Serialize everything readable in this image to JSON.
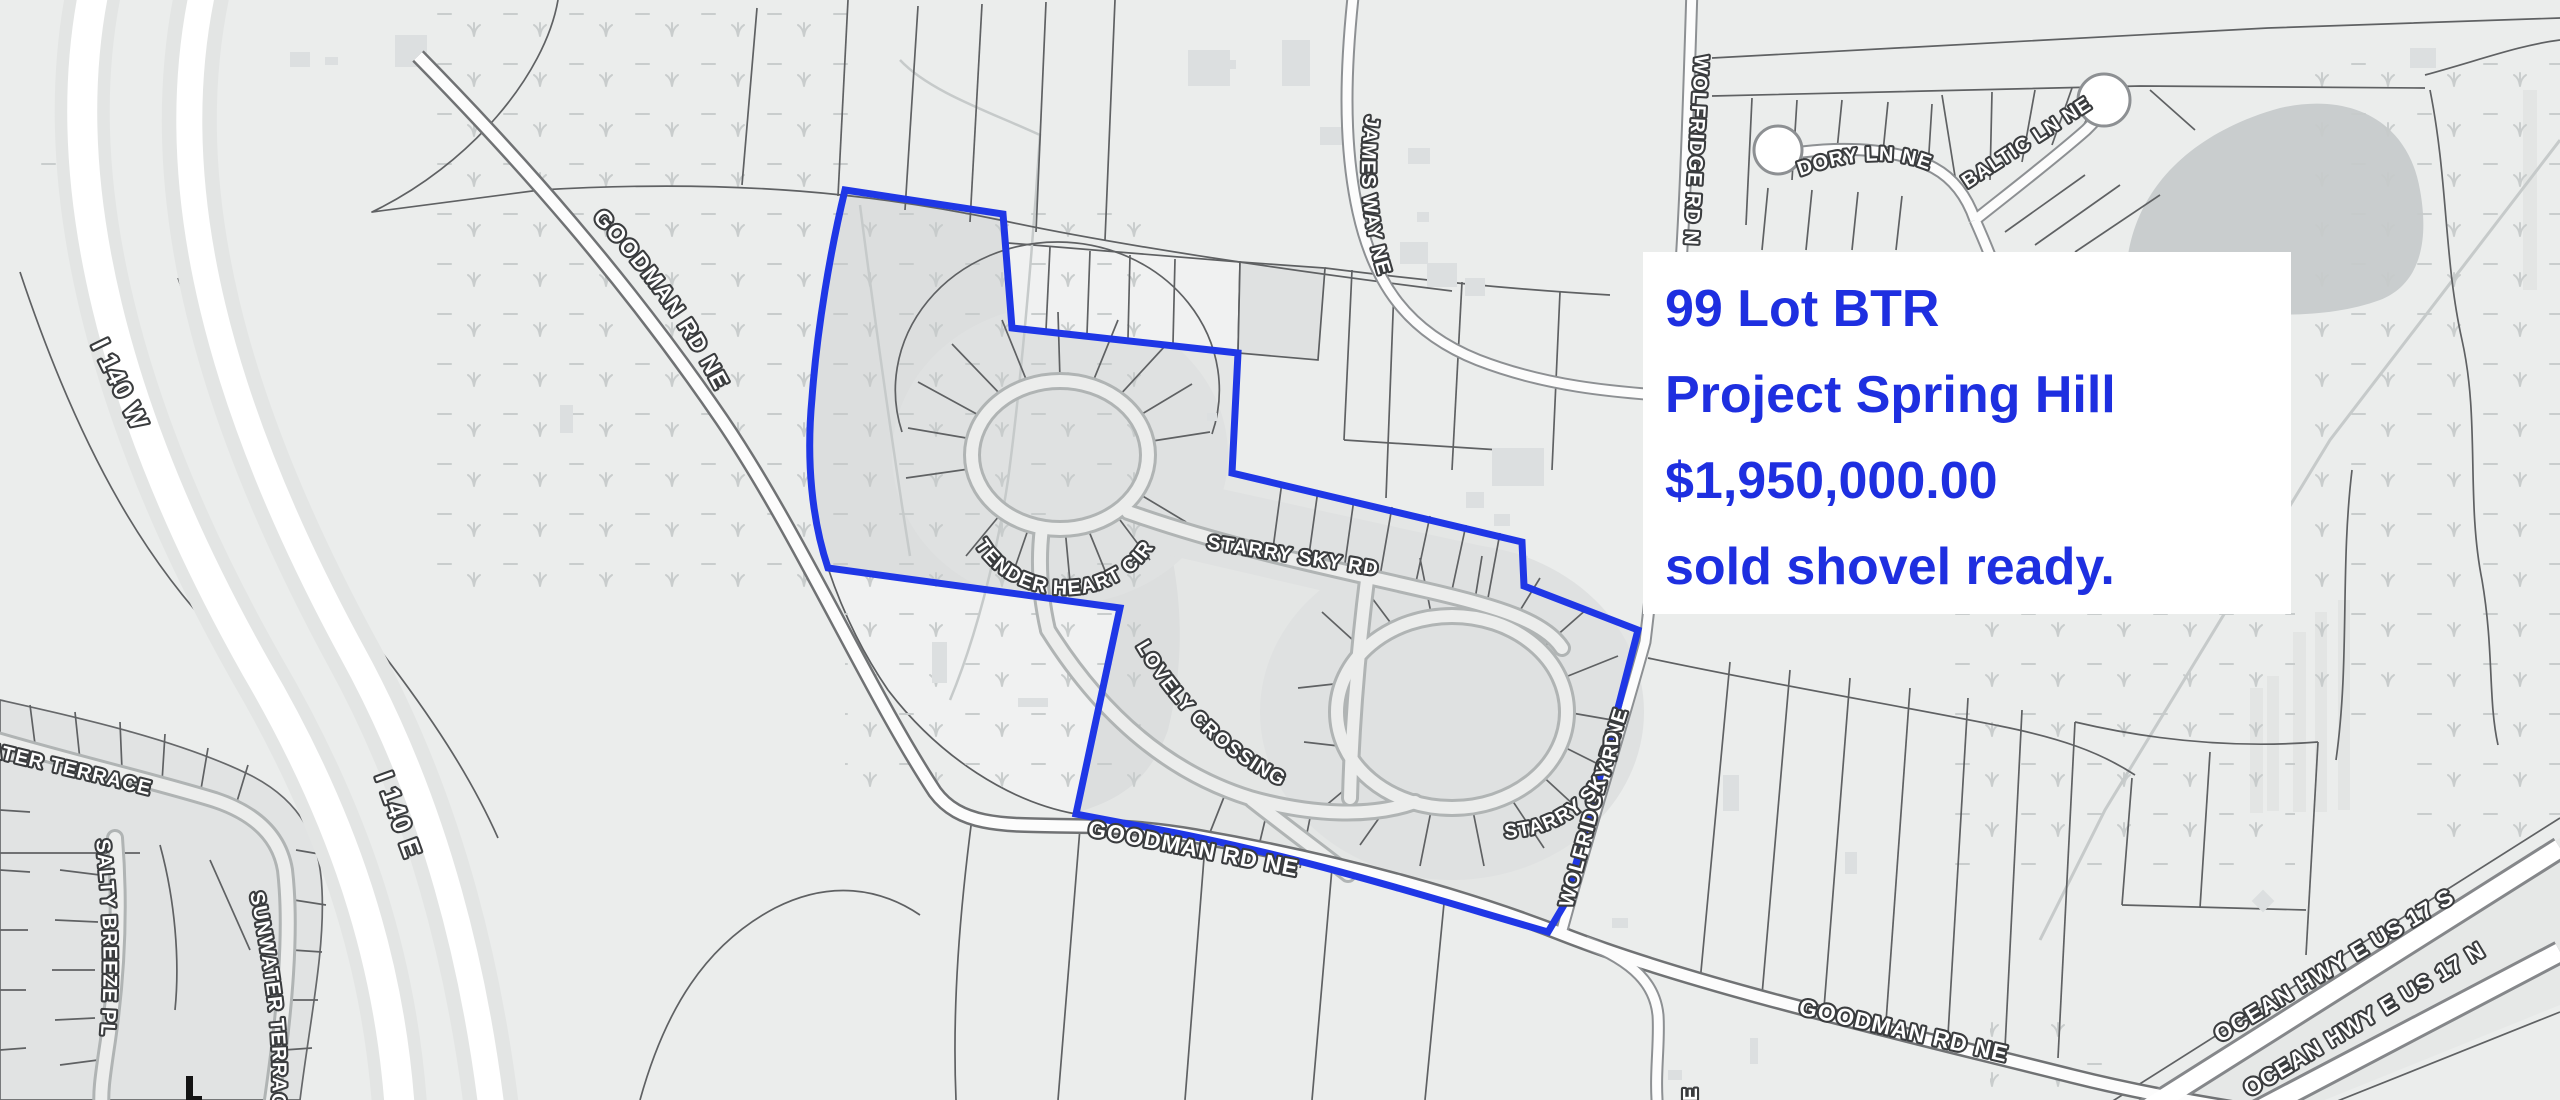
{
  "annotation": {
    "lines": [
      "99 Lot BTR",
      "Project Spring Hill",
      "$1,950,000.00",
      "sold shovel ready."
    ],
    "text_color": "#1e2fe0",
    "background": "#ffffff"
  },
  "map": {
    "boundary_color": "#1f37e6",
    "road_labels": {
      "i140_w": "I 140 W",
      "i140_e": "I 140 E",
      "goodman_upper": "GOODMAN RD NE",
      "goodman_mid": "GOODMAN RD NE",
      "goodman_lower": "GOODMAN RD NE",
      "james_way": "JAMES WAY NE",
      "wolfridge_n": "WOLFRIDGE RD N",
      "wolfridge_ne": "WOLFRIDGE RD NE",
      "dory": "DORY LN NE",
      "baltic": "BALTIC LN NE",
      "tender_heart": "TENDER HEART CIR",
      "starry_sky_main": "STARRY SKY RD",
      "starry_sky_loop": "STARRY SKY RD",
      "lovely_crossing": "LOVELY CROSSING",
      "sunwater_top": "SUNWATER TERRACE",
      "sunwater_side": "SUNWATER TERRACE",
      "salty_breeze": "SALTY BREEZE PL",
      "ocean_s": "OCEAN HWY E US 17 S",
      "ocean_n": "OCEAN HWY E US 17 N",
      "partial_s": "E"
    }
  }
}
